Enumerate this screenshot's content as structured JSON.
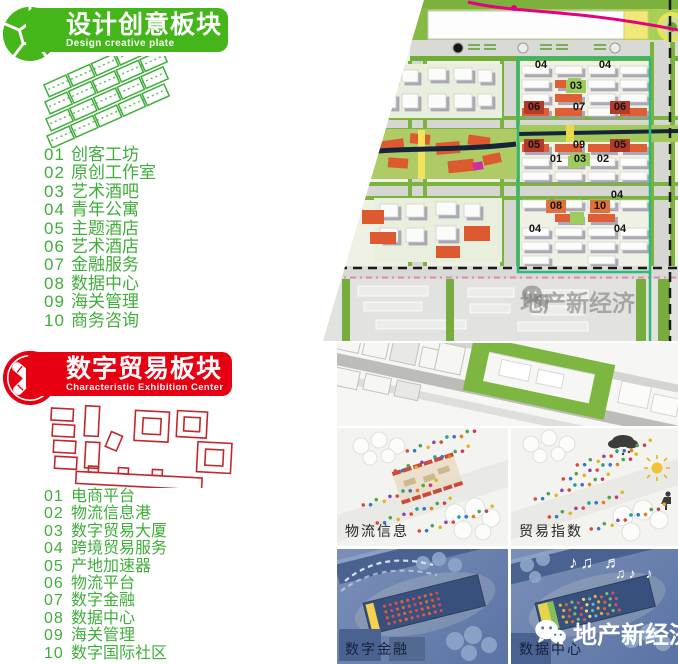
{
  "colors": {
    "green": "#44b619",
    "red": "#e60012",
    "list_green": "#3fae3a",
    "teal_outline": "#2eb87e",
    "magenta": "#e5007f",
    "panel_blue": "#6b82ad"
  },
  "design_section": {
    "title": "设计创意板块",
    "subtitle": "Design creative plate",
    "items": [
      {
        "num": "01",
        "label": "创客工坊"
      },
      {
        "num": "02",
        "label": "原创工作室"
      },
      {
        "num": "03",
        "label": "艺术酒吧"
      },
      {
        "num": "04",
        "label": "青年公寓"
      },
      {
        "num": "05",
        "label": "主题酒店"
      },
      {
        "num": "06",
        "label": "艺术酒店"
      },
      {
        "num": "07",
        "label": "金融服务"
      },
      {
        "num": "08",
        "label": "数据中心"
      },
      {
        "num": "09",
        "label": "海关管理"
      },
      {
        "num": "10",
        "label": "商务咨询"
      }
    ]
  },
  "trade_section": {
    "title": "数字贸易板块",
    "subtitle": "Characteristic Exhibition Center",
    "items": [
      {
        "num": "01",
        "label": "电商平台"
      },
      {
        "num": "02",
        "label": "物流信息港"
      },
      {
        "num": "03",
        "label": "数字贸易大厦"
      },
      {
        "num": "04",
        "label": "跨境贸易服务"
      },
      {
        "num": "05",
        "label": "产地加速器"
      },
      {
        "num": "06",
        "label": "物流平台"
      },
      {
        "num": "07",
        "label": "数字金融"
      },
      {
        "num": "08",
        "label": "数据中心"
      },
      {
        "num": "09",
        "label": "海关管理"
      },
      {
        "num": "10",
        "label": "数字国际社区"
      }
    ]
  },
  "map": {
    "labels": [
      {
        "text": "04"
      },
      {
        "text": "04"
      },
      {
        "text": "03"
      },
      {
        "text": "06"
      },
      {
        "text": "07"
      },
      {
        "text": "06"
      },
      {
        "text": "05"
      },
      {
        "text": "09"
      },
      {
        "text": "05"
      },
      {
        "text": "01"
      },
      {
        "text": "03"
      },
      {
        "text": "02"
      },
      {
        "text": "04"
      },
      {
        "text": "08"
      },
      {
        "text": "10"
      },
      {
        "text": "04"
      },
      {
        "text": "04"
      }
    ],
    "watermark": "地产新经济"
  },
  "renders": {
    "panels": [
      {
        "label": "物流信息"
      },
      {
        "label": "贸易指数"
      },
      {
        "label": "数字金融"
      },
      {
        "label": "数据中心"
      }
    ],
    "notes_a": "♪♫ ♬",
    "notes_b": "♫♪ ♪",
    "watermark": "地产新经济"
  }
}
